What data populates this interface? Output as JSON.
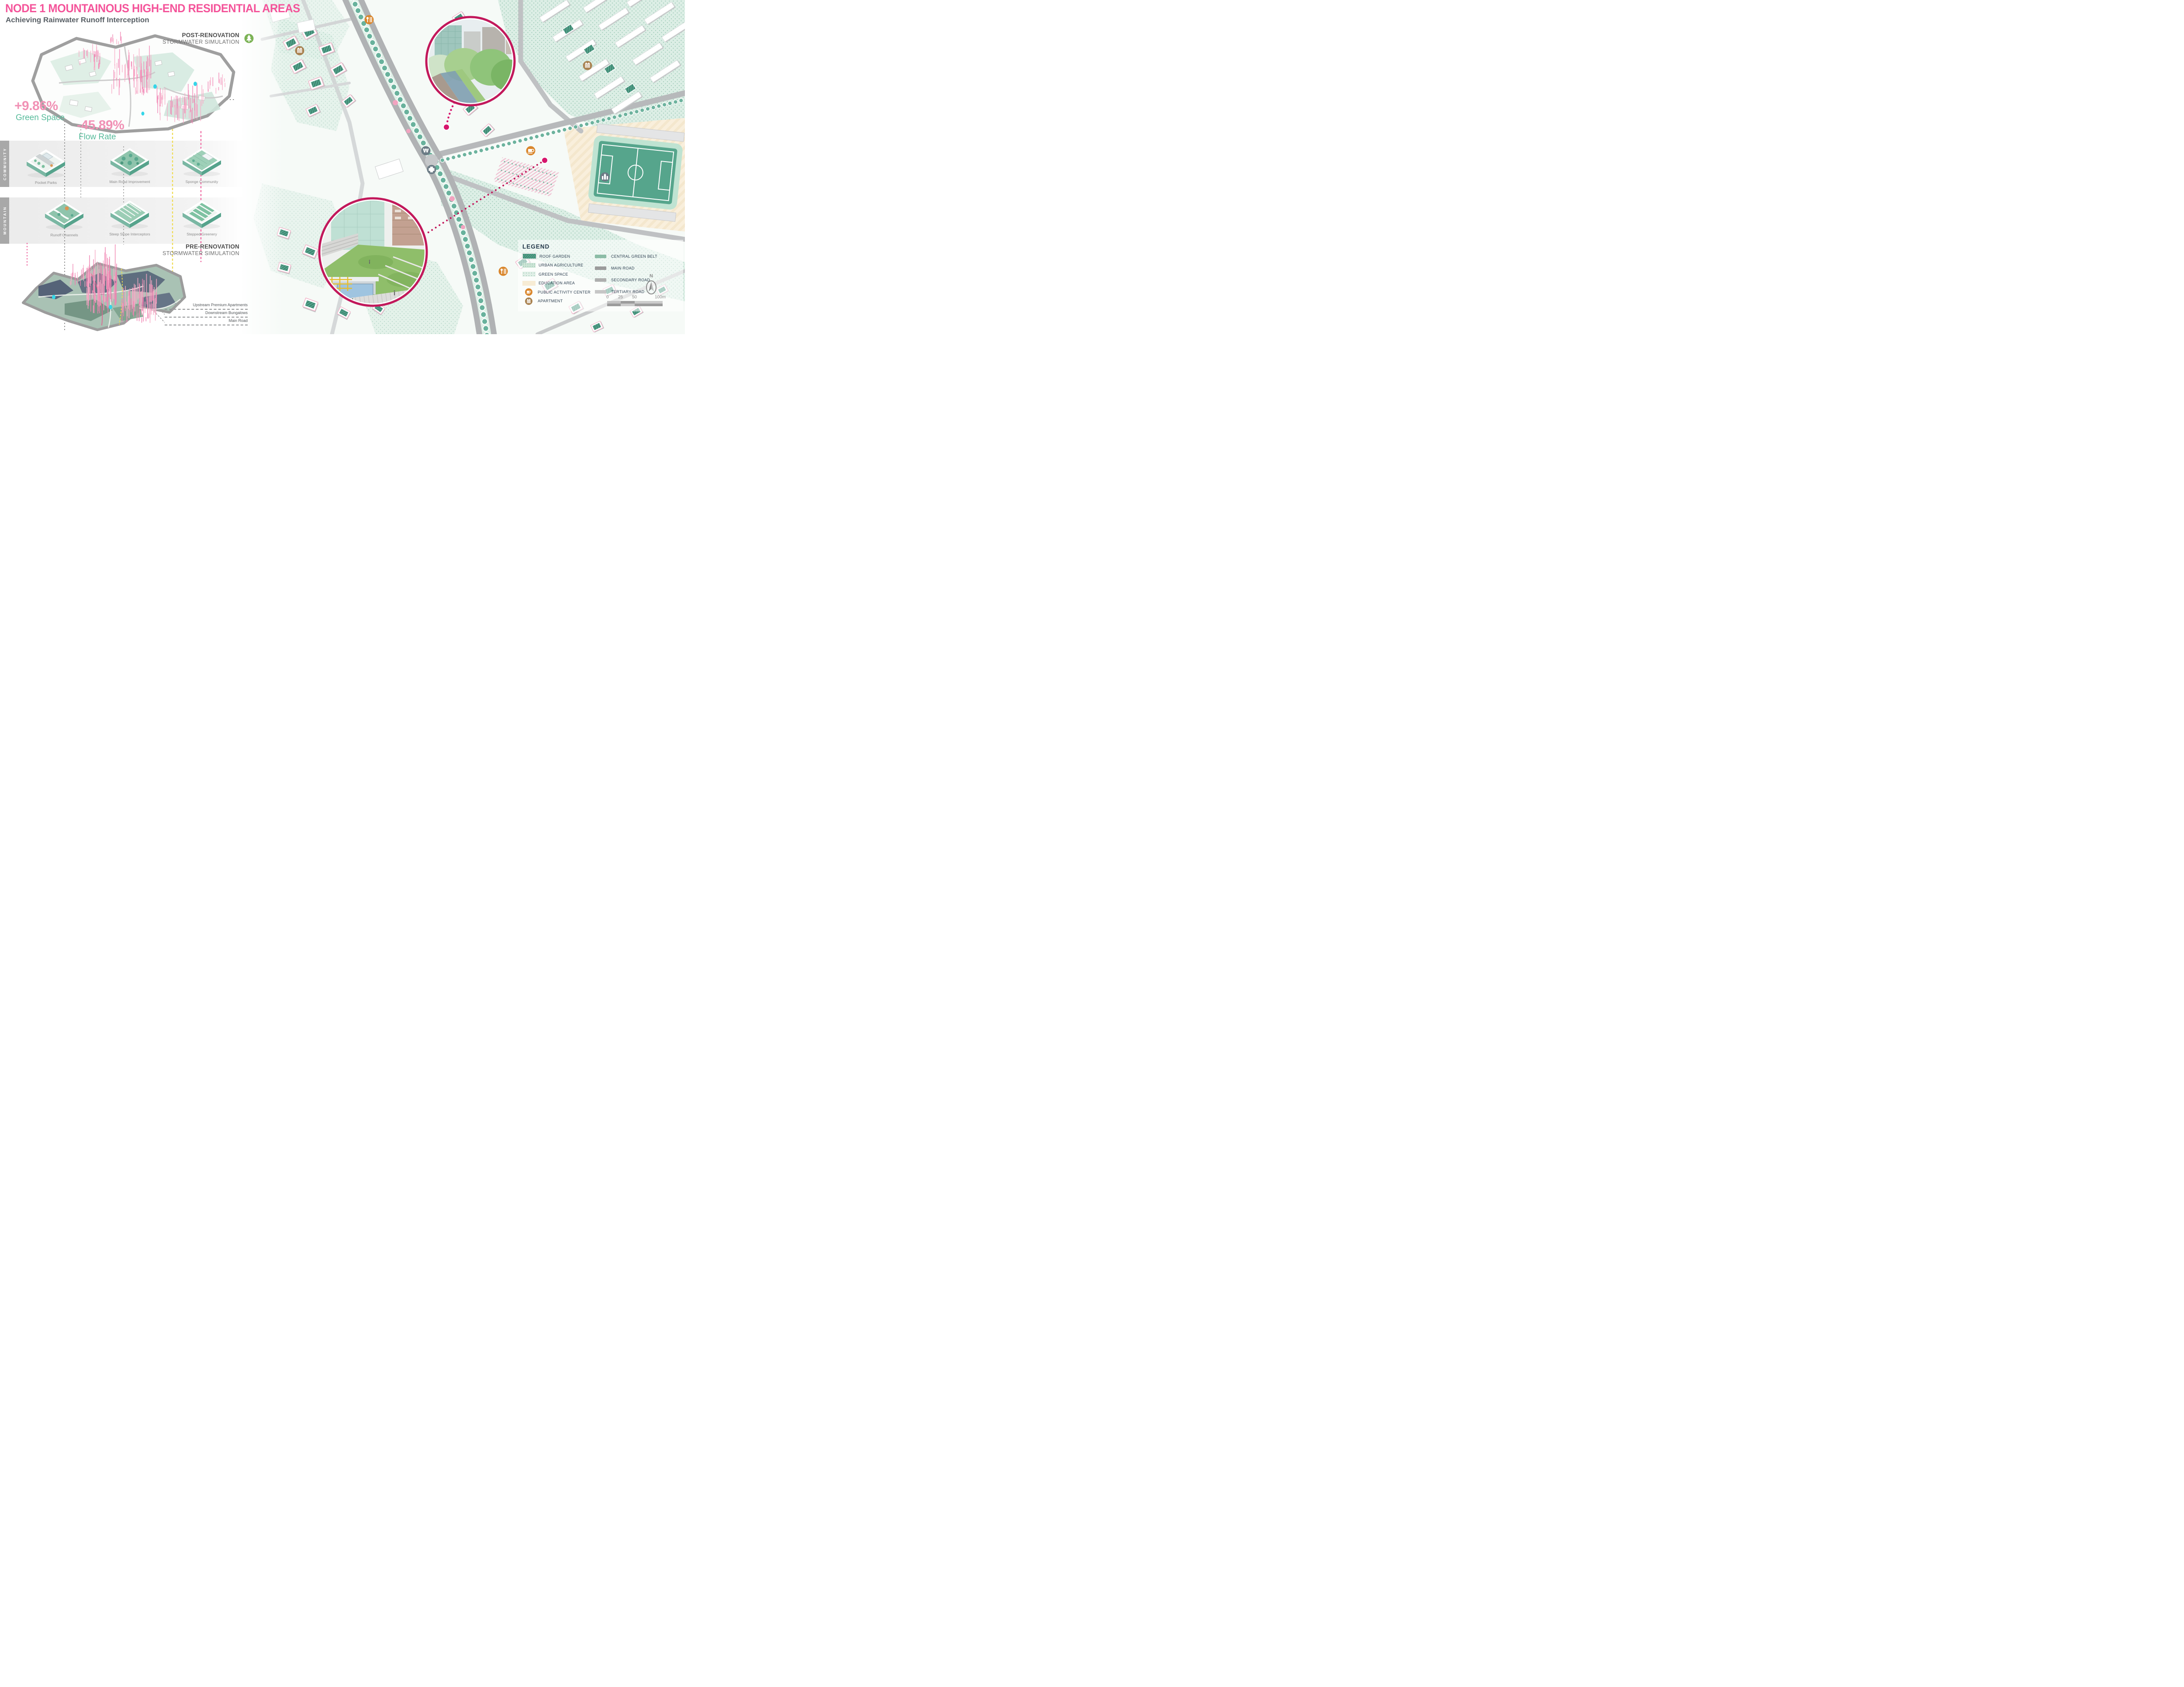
{
  "header": {
    "title": "NODE 1 MOUNTAINOUS HIGH-END RESIDENTIAL AREAS",
    "subtitle": "Achieving Rainwater Runoff Interception"
  },
  "post_renovation": {
    "title": "POST-RENOVATION",
    "subtitle": "STORMWATER SIMULATION"
  },
  "pre_renovation": {
    "title": "PRE-RENOVATION",
    "subtitle": "STORMWATER SIMULATION"
  },
  "stats": {
    "green_space_value": "+9.86%",
    "green_space_label": "Green Space",
    "flow_rate_value": "-45.89%",
    "flow_rate_label": "Flow Rate"
  },
  "community": {
    "label": "COMMUNITY",
    "items": [
      "Pocket Parks",
      "Main Road Improvement",
      "Sponge Community"
    ]
  },
  "mountain": {
    "label": "MOUNTAIN",
    "items": [
      "Runoff Channels",
      "Steep Slope Interceptors",
      "Stepped Greenery"
    ]
  },
  "annotations": {
    "a1": "Upstream Premium Apartments",
    "a2": "Downstream Bungalows",
    "a3": "Main Road"
  },
  "legend": {
    "title": "LEGEND",
    "areas": {
      "roof_garden": "ROOF GARDEN",
      "urban_agriculture": "URBAN AGRICULTURE",
      "green_space": "GREEN SPACE",
      "education_area": "EDUCATION AREA",
      "public_activity_center": "PUBLIC ACTIVITY CENTER",
      "apartment": "APARTMENT"
    },
    "lines": {
      "central_green_belt": "CENTRAL GREEN BELT",
      "main_road": "MAIN ROAD",
      "secondary_road": "SECONDARY ROAD",
      "tertiary_road": "TERTIARY ROAD"
    }
  },
  "map": {
    "north_label": "N",
    "scale": {
      "t0": "0",
      "t1": "25",
      "t2": "50",
      "t3": "100m"
    }
  },
  "colors": {
    "accent_pink": "#F4549A",
    "stat_pink": "#F191B5",
    "stat_green": "#57BB9B",
    "callout_ring": "#C2185B",
    "roof_teal": "#4FA08B",
    "legend_text": "#2C3E50",
    "poi_orange": "#D9862C",
    "poi_brown": "#A8814F",
    "poi_slate": "#6B7B85"
  }
}
